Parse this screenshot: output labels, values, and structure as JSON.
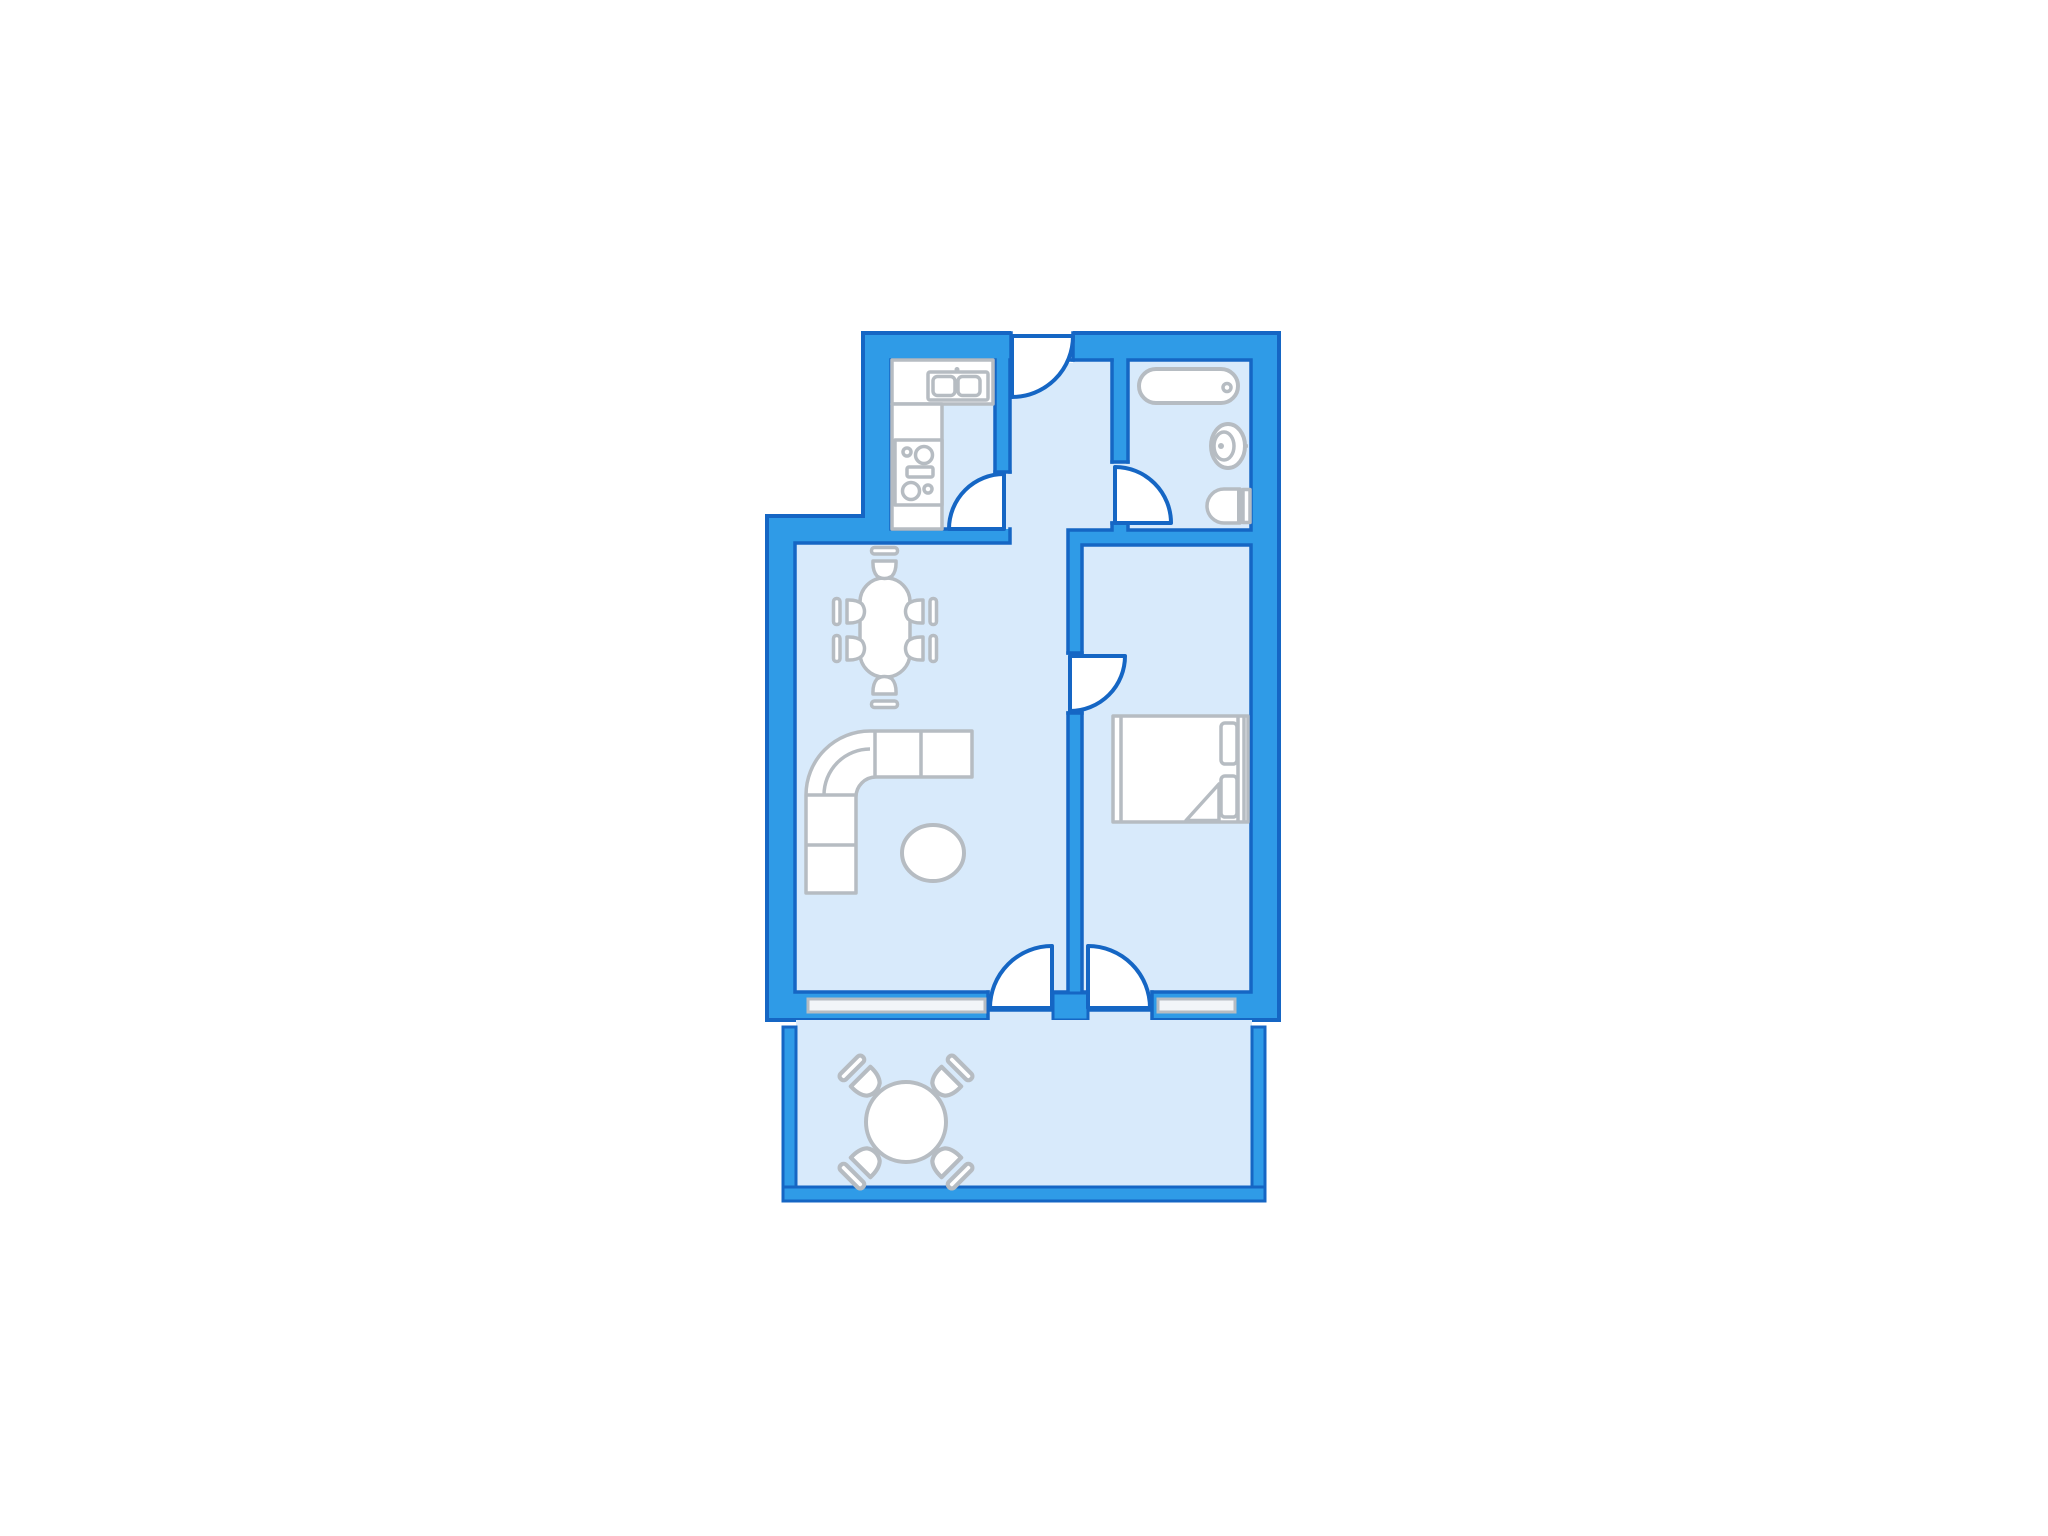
{
  "document": {
    "kind": "apartment-floor-plan",
    "visible_text": []
  },
  "colors": {
    "background": "#ffffff",
    "wall_fill": "#2F9BE7",
    "wall_stroke": "#1566C4",
    "floor_fill": "#D8EAFB",
    "furniture_fill": "#FFFFFF",
    "furniture_stroke": "#B6BCC2",
    "window_fill": "#F2F5F8"
  },
  "rooms": [
    {
      "name": "kitchen",
      "features": [
        "counter",
        "double-sink",
        "stove"
      ]
    },
    {
      "name": "hallway",
      "features": [
        "entrance-door"
      ]
    },
    {
      "name": "bathroom",
      "features": [
        "bathtub",
        "wash-basin",
        "toilet"
      ]
    },
    {
      "name": "living-room",
      "features": [
        "dining-table",
        "six-chairs",
        "corner-sofa",
        "coffee-table"
      ]
    },
    {
      "name": "bedroom",
      "features": [
        "double-bed"
      ]
    },
    {
      "name": "balcony",
      "features": [
        "round-table",
        "four-chairs"
      ]
    }
  ],
  "doors": [
    {
      "name": "entrance-door",
      "location": "top-wall"
    },
    {
      "name": "kitchen-door",
      "location": "kitchen-hallway-wall"
    },
    {
      "name": "bathroom-door",
      "location": "bathroom-hallway-wall"
    },
    {
      "name": "bedroom-door",
      "location": "living-bedroom-wall"
    },
    {
      "name": "living-balcony-door",
      "location": "bottom-wall"
    },
    {
      "name": "bedroom-balcony-door",
      "location": "bottom-wall"
    }
  ],
  "windows": [
    {
      "name": "living-room-window",
      "location": "bottom-wall"
    },
    {
      "name": "bedroom-window",
      "location": "bottom-wall"
    }
  ]
}
